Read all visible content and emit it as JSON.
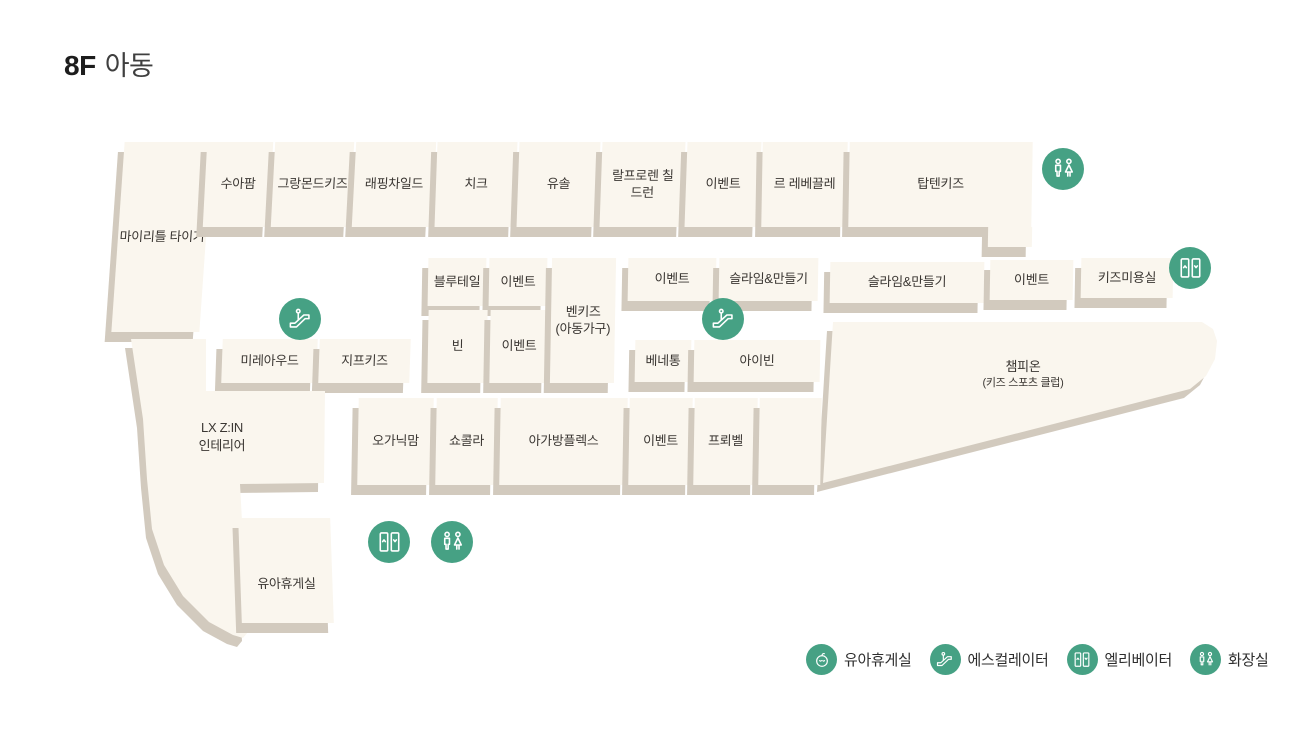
{
  "title": {
    "floor": "8F",
    "category": "아동"
  },
  "stores": {
    "my_little_tiger": "마이리틀 타이거",
    "suafarm": "수아팜",
    "grandmonde_kids": "그랑몬드키즈",
    "lapping_child": "래핑차일드",
    "chic": "치크",
    "yusol": "유솔",
    "ralph_lauren_children": "랄프로렌 칠드런",
    "event": "이벤트",
    "le_rebekkeulle": "르 레베끌레",
    "topten_kids": "탑텐키즈",
    "kids_salon": "키즈미용실",
    "bluetail": "블루테일",
    "bin": "빈",
    "benkids_name": "벤키즈",
    "benkids_sub": "(아동가구)",
    "slime_making": "슬라임&만들기",
    "benetton": "베네통",
    "ivin": "아이빈",
    "champion_name": "챔피온",
    "champion_sub": "(키즈 스포츠 클럽)",
    "mireaude": "미레아우드",
    "jeep_kids": "지프키즈",
    "lx_zin_line1": "LX Z:IN",
    "lx_zin_line2": "인테리어",
    "nursery": "유아휴게실",
    "organic_mom": "오가닉맘",
    "chocola": "쇼콜라",
    "agabang_flex": "아가방플렉스",
    "froebel": "프뢰벨"
  },
  "legend": {
    "items": [
      {
        "id": "nursing-room",
        "label": "유아휴게실"
      },
      {
        "id": "escalator",
        "label": "에스컬레이터"
      },
      {
        "id": "elevator",
        "label": "엘리베이터"
      },
      {
        "id": "restroom",
        "label": "화장실"
      }
    ]
  },
  "colors": {
    "background": "#FFFFFF",
    "block_fill": "#FAF6EE",
    "block_side": "#D2CABE",
    "icon_green": "#46A184",
    "label_text": "#3B3733",
    "title_text": "#1D1D1D"
  }
}
